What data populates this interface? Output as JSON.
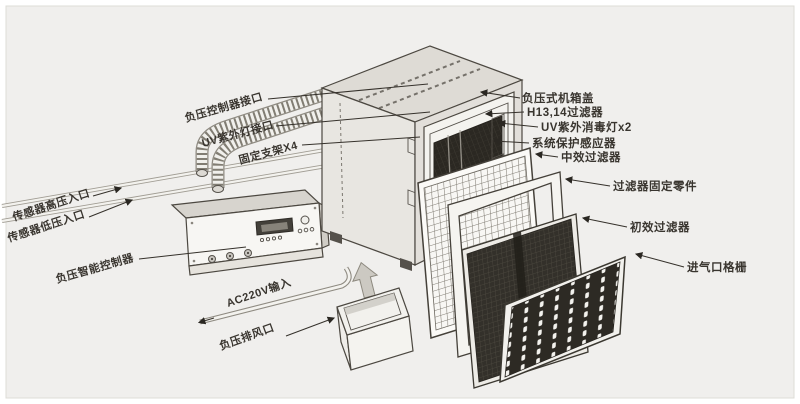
{
  "diagram_type": "exploded-parts-diagram",
  "colors": {
    "background": "#f0efed",
    "line": "#4c4841",
    "text": "#39352f",
    "dark_panel": "#2d2a24",
    "light_face": "#e8e6e1"
  },
  "labels": {
    "left": [
      {
        "id": "np-controller-port",
        "text": "负压控制器接口"
      },
      {
        "id": "uv-lamp-port",
        "text": "UV紫外灯接口"
      },
      {
        "id": "fixing-bracket",
        "text": "固定支架X4"
      },
      {
        "id": "sensor-high-inlet",
        "text": "传感器高压入口"
      },
      {
        "id": "sensor-low-inlet",
        "text": "传感器低压入口"
      },
      {
        "id": "smart-controller",
        "text": "负压智能控制器"
      },
      {
        "id": "ac-input",
        "text": "AC220V输入"
      },
      {
        "id": "exhaust-outlet",
        "text": "负压排风口"
      }
    ],
    "right": [
      {
        "id": "case-cover",
        "text": "负压式机箱盖"
      },
      {
        "id": "hepa-filter",
        "text": "H13,14过滤器"
      },
      {
        "id": "uv-sterilize-lamp",
        "text": "UV紫外消毒灯x2"
      },
      {
        "id": "protect-sensor",
        "text": "系统保护感应器"
      },
      {
        "id": "medium-filter",
        "text": "中效过滤器"
      },
      {
        "id": "filter-fixing",
        "text": "过滤器固定零件"
      },
      {
        "id": "primary-filter",
        "text": "初效过滤器"
      },
      {
        "id": "inlet-grille",
        "text": "进气口格栅"
      }
    ]
  }
}
